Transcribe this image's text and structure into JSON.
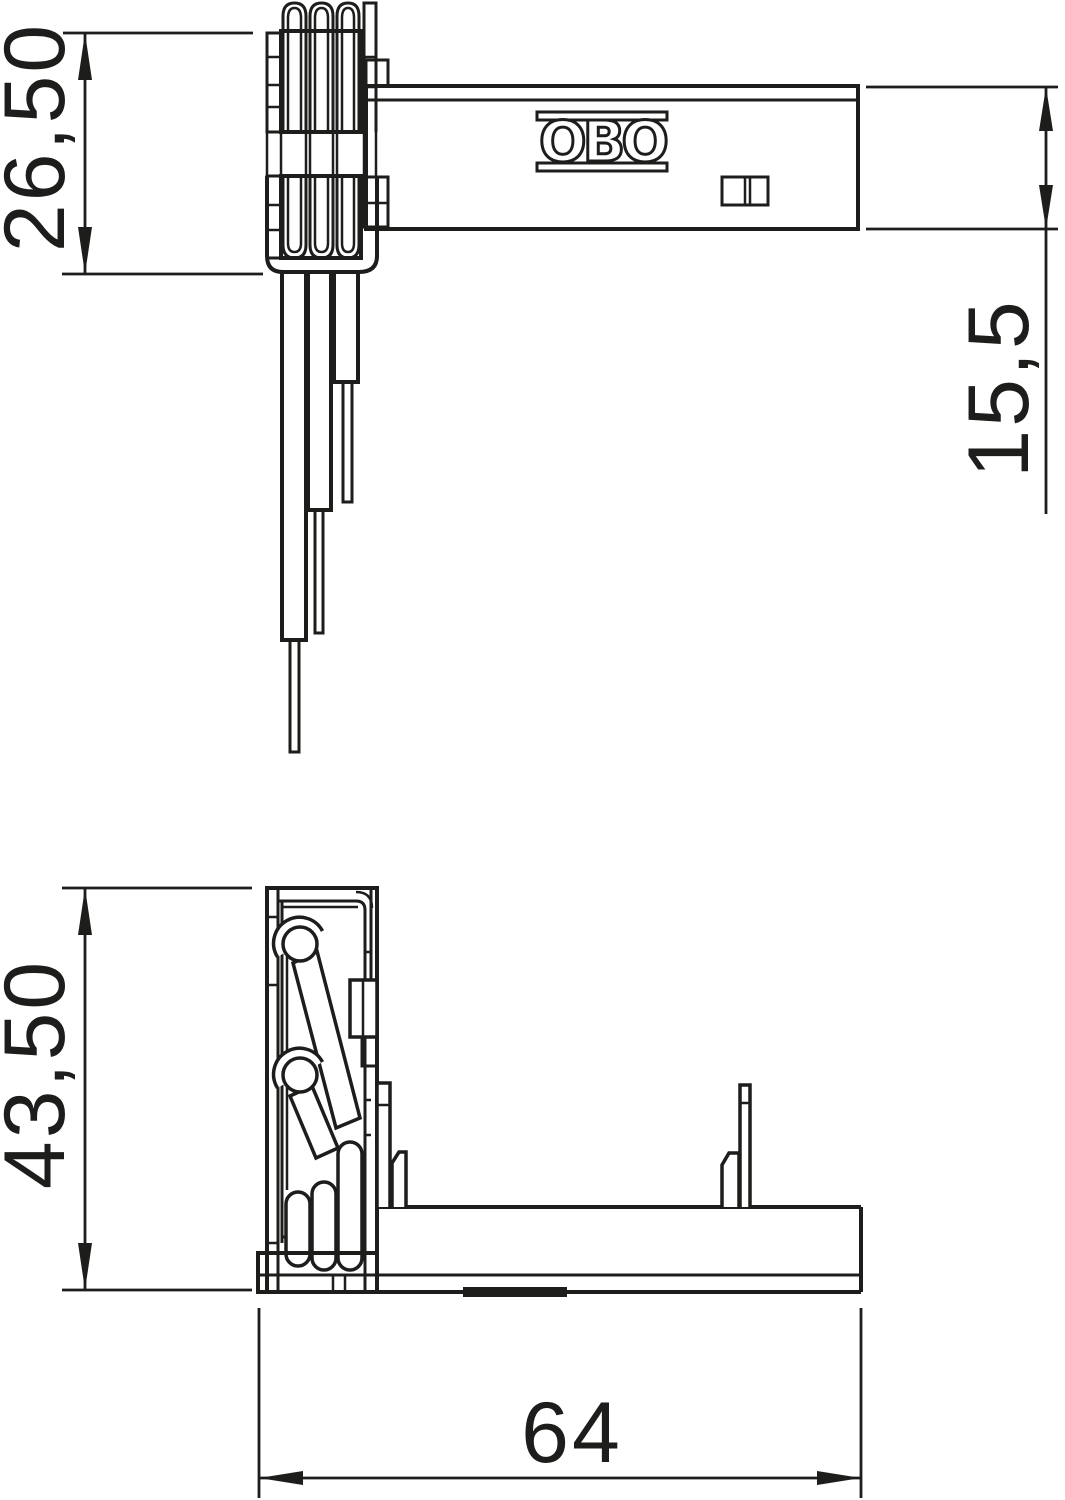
{
  "drawing": {
    "background_color": "#ffffff",
    "line_color": "#1d1d1b",
    "logo": "OBO",
    "dimensions": {
      "clip_stack_height": {
        "label": "26,50",
        "orientation": "vertical",
        "view": "top"
      },
      "arm_width": {
        "label": "15,5",
        "orientation": "vertical",
        "view": "top"
      },
      "body_height": {
        "label": "43,50",
        "orientation": "vertical",
        "view": "side"
      },
      "base_length": {
        "label": "64",
        "orientation": "horizontal",
        "view": "side"
      }
    }
  }
}
